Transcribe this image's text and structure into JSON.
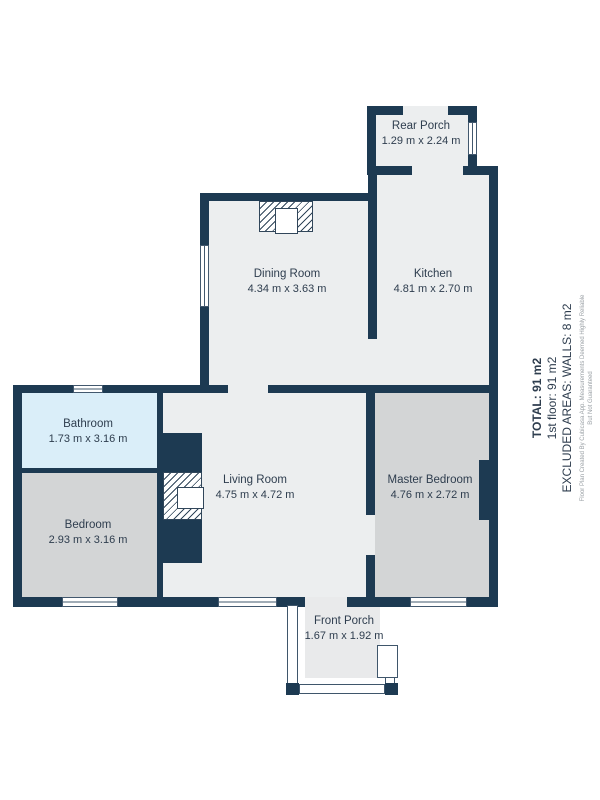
{
  "floorplan": {
    "rooms": {
      "rear_porch": {
        "name": "Rear Porch",
        "dims": "1.29 m x 2.24 m"
      },
      "kitchen": {
        "name": "Kitchen",
        "dims": "4.81 m x 2.70 m"
      },
      "dining_room": {
        "name": "Dining Room",
        "dims": "4.34 m x 3.63 m"
      },
      "bathroom": {
        "name": "Bathroom",
        "dims": "1.73 m x 3.16 m"
      },
      "bedroom": {
        "name": "Bedroom",
        "dims": "2.93 m x 3.16 m"
      },
      "living_room": {
        "name": "Living Room",
        "dims": "4.75 m x 4.72 m"
      },
      "master_bedroom": {
        "name": "Master Bedroom",
        "dims": "4.76 m x 2.72 m"
      },
      "front_porch": {
        "name": "Front Porch",
        "dims": "1.67 m x 1.92 m"
      }
    },
    "summary": {
      "total": "TOTAL: 91 m2",
      "floor": "1st floor: 91 m2",
      "excluded": "EXCLUDED AREAS: WALLS: 8 m2",
      "disclaimer": "Floor Plan Created By Cubicasa App. Measurements Deemed Highly Reliable But Not Guaranteed"
    },
    "colors": {
      "wall": "#1d3a52",
      "floor_light": "#eceeef",
      "floor_gray": "#d3d5d6",
      "bathroom_blue": "#daeef9",
      "porch_floor": "#e9eaeb"
    }
  }
}
